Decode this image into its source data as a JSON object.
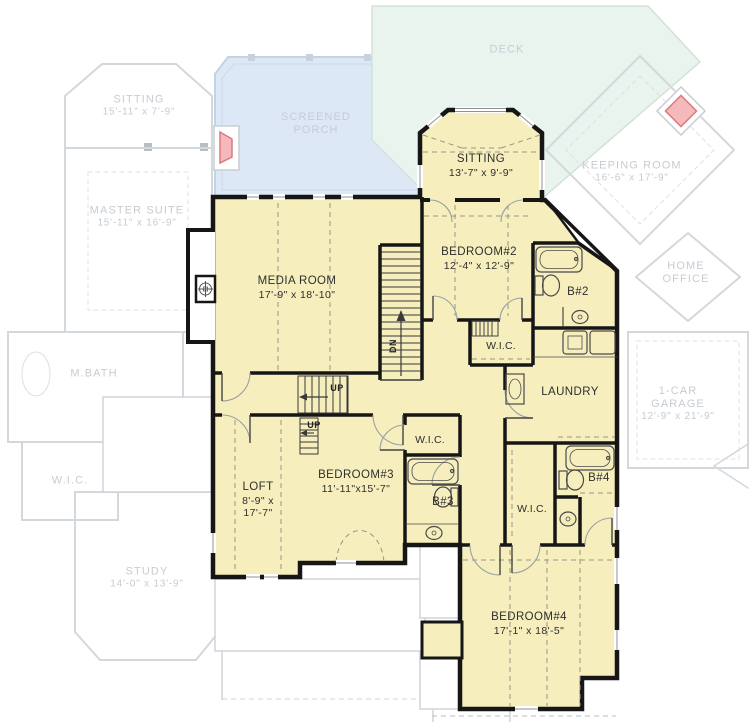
{
  "plan_type": "second-floor-plan",
  "colors": {
    "active_fill": "#f6efbd",
    "wall": "#161616",
    "porch_fill": "#dce8f6",
    "deck_fill": "#e9f4ee",
    "ghost_line": "#d3d8dc",
    "ghost_text": "#c6ccd2",
    "fireplace_pink": "#f5b9bb",
    "fireplace_red": "#db7a7d",
    "dashed_ceiling": "#98948a"
  },
  "rooms": {
    "media": {
      "name": "MEDIA ROOM",
      "dims": "17'-9\" x 18'-10\""
    },
    "sitting": {
      "name": "SITTING",
      "dims": "13'-7\" x 9'-9\""
    },
    "bedroom2": {
      "name": "BEDROOM#2",
      "dims": "12'-4\" x 12'-9\""
    },
    "bath2": {
      "name": "B#2"
    },
    "wic2": {
      "name": "W.I.C."
    },
    "laundry": {
      "name": "LAUNDRY"
    },
    "bedroom3": {
      "name": "BEDROOM#3",
      "dims": "11'-11\"x15'-7\""
    },
    "wic3": {
      "name": "W.I.C."
    },
    "bath3": {
      "name": "B#3"
    },
    "loft": {
      "name": "LOFT",
      "dims1": "8'-9\" x",
      "dims2": "17'-7\""
    },
    "wic4": {
      "name": "W.I.C."
    },
    "bath4": {
      "name": "B#4"
    },
    "bedroom4": {
      "name": "BEDROOM#4",
      "dims": "17'-1\" x 18'-5\""
    }
  },
  "stairs": {
    "up_hall": "UP",
    "up_loft": "UP",
    "down": "DN"
  },
  "ghost_rooms": {
    "sitting": {
      "name": "SITTING",
      "dims": "15'-11\" x 7'-9\""
    },
    "master": {
      "name": "MASTER SUITE",
      "dims": "15'-11\" x 16'-9\""
    },
    "mbath": {
      "name": "M.BATH"
    },
    "wic": {
      "name": "W.I.C."
    },
    "study": {
      "name": "STUDY",
      "dims": "14'-0\" x 13'-9\""
    },
    "porch": {
      "line1": "SCREENED",
      "line2": "PORCH"
    },
    "deck": {
      "name": "DECK"
    },
    "keeping": {
      "name": "KEEPING ROOM",
      "dims": "16'-6\" x 17'-9\""
    },
    "office": {
      "line1": "HOME",
      "line2": "OFFICE"
    },
    "garage": {
      "line1": "1-CAR",
      "line2": "GARAGE",
      "dims": "12'-9\" x 21'-9\""
    }
  },
  "icons": {
    "ceiling_fan": "ceiling-fan-icon",
    "bathtub": "bathtub-icon",
    "toilet": "toilet-icon",
    "sink": "sink-icon",
    "washer": "washer-icon",
    "dryer": "dryer-icon",
    "stair_arrow": "stair-direction-arrow"
  }
}
